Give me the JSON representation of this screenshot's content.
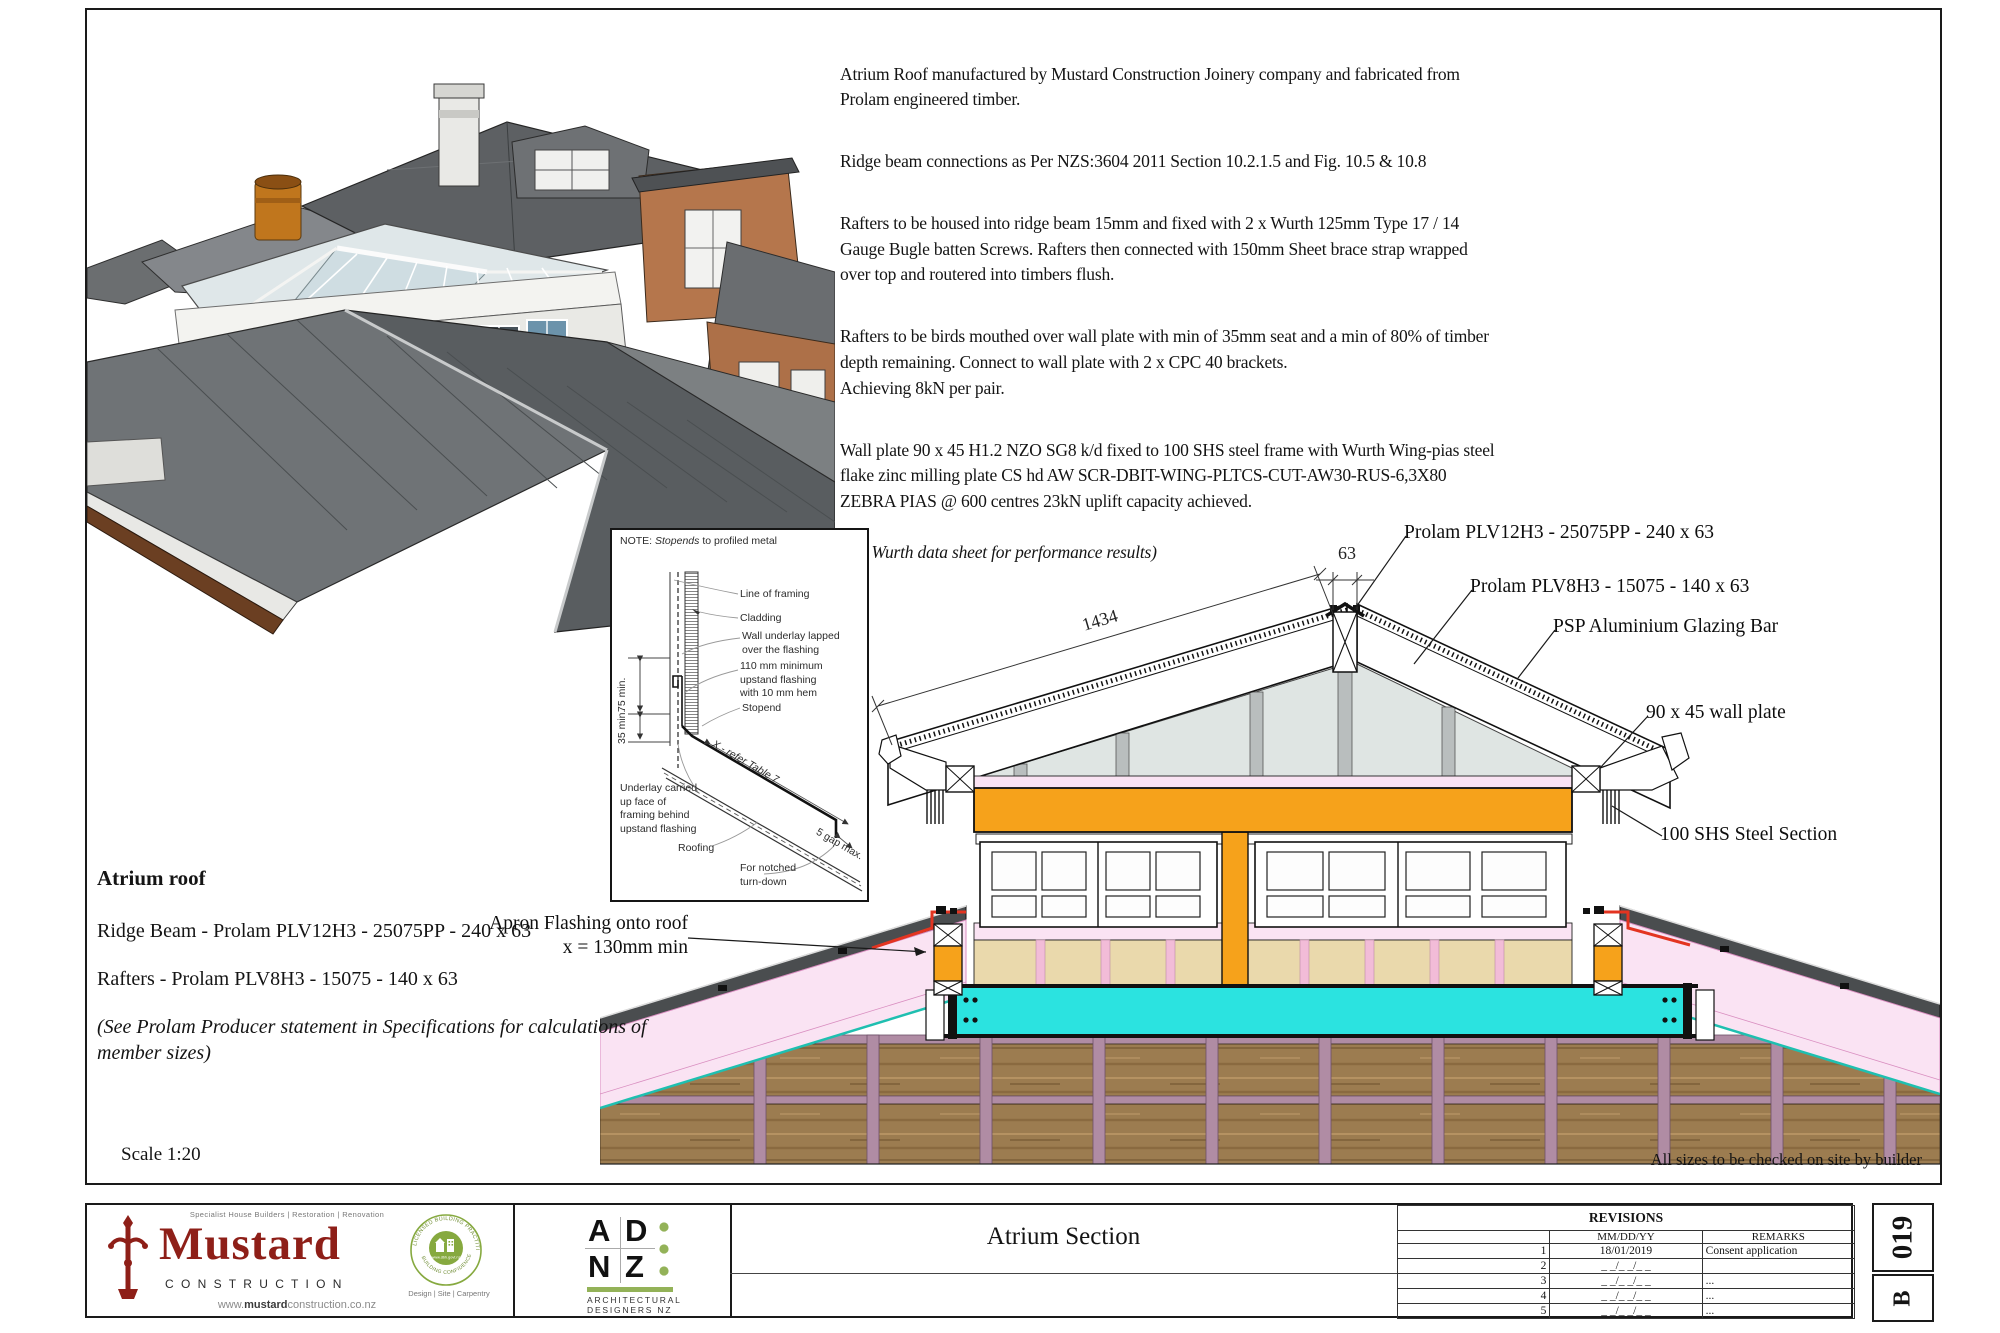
{
  "colors": {
    "orange": "#F6A21B",
    "cyan": "#2BE3E0",
    "pink_fill": "#FAE3F3",
    "pink_line": "#D98EC0",
    "tan": "#EAD9AC",
    "mauve": "#B08CA4",
    "wood": "#9C7C50",
    "teal_line": "#1FBFB0",
    "glazing": "#DFE5E3",
    "mullion_grey": "#B9BEBE",
    "flashing_red": "#E33420",
    "mustard_red": "#8E1F18",
    "adnz_green": "#93B258",
    "badge_green": "#86A93F"
  },
  "spec_notes": {
    "p1": "Atrium Roof manufactured by Mustard Construction Joinery company and fabricated from\nProlam engineered timber.",
    "p2": "Ridge beam connections  as Per NZS:3604 2011 Section 10.2.1.5 and Fig. 10.5 & 10.8",
    "p3": "Rafters to be housed into ridge beam 15mm and fixed with 2 x Wurth 125mm Type 17 / 14\nGauge Bugle batten Screws. Rafters then connected with 150mm Sheet brace strap wrapped\nover top and routered  into timbers flush.",
    "p4": "Rafters to be birds mouthed over wall plate with min of 35mm seat and a min of 80% of timber\ndepth remaining. Connect to wall plate with 2 x CPC 40 brackets.\nAchieving 8kN per pair.",
    "p5": "Wall plate 90 x 45 H1.2 NZO SG8 k/d fixed to 100 SHS steel frame with Wurth Wing-pias steel\nflake zinc milling plate CS hd AW SCR-DBIT-WING-PLTCS-CUT-AW30-RUS-6,3X80\nZEBRA PIAS @ 600 centres 23kN uplift capacity achieved.",
    "p6": "(see Wurth data sheet for performance results)"
  },
  "inset": {
    "note_prefix": "NOTE:",
    "note_italic": "Stopends",
    "note_suffix": "to profiled metal",
    "labels": {
      "line_of_framing": "Line of framing",
      "cladding": "Cladding",
      "wall_underlay": "Wall underlay lapped\nover the flashing",
      "upstand": "110 mm minimum\nupstand flashing\nwith 10 mm hem",
      "stopend": "Stopend",
      "x_refer": "X - refer Table 7",
      "gap": "5 gap max.",
      "underlay_carried": "Underlay carried\nup face of\nframing behind\nupstand flashing",
      "roofing": "Roofing",
      "notched": "For notched\nturn-down",
      "dim75": "75 min.",
      "dim35": "35 min."
    }
  },
  "section": {
    "labels": {
      "ridge_beam": "Prolam PLV12H3 - 25075PP - 240 x 63",
      "rafter": "Prolam PLV8H3 - 15075  - 140 x 63",
      "glazing_bar": "PSP Aluminium Glazing Bar",
      "wall_plate": "90 x 45 wall plate",
      "shs": "100 SHS Steel Section",
      "apron": "Apron Flashing onto roof\nx = 130mm min"
    },
    "dims": {
      "ridge_width": "63",
      "rafter_length": "1434"
    }
  },
  "roof_schedule": {
    "heading": "Atrium roof",
    "ridge_beam": "Ridge Beam - Prolam PLV12H3 - 25075PP - 240 x 63",
    "rafters": "Rafters - Prolam PLV8H3 - 15075 - 140 x 63",
    "note": "(See Prolam Producer statement in Specifications for calculations of\nmember sizes)",
    "scale": "Scale 1:20"
  },
  "footer_note": "All sizes to be checked on site by builder",
  "title_block": {
    "mustard": {
      "tagline": "Specialist House Builders | Restoration | Renovation",
      "name": "Mustard",
      "sub": "C O N S T R U C T I O N",
      "badge_top": "LICENSED BUILDING PRACTITIONER",
      "badge_url": "www.dbh.govt.nz",
      "badge_bottom": "BUILDING CONFIDENCE",
      "services": "Design | Site | Carpentry",
      "web_prefix": "www.",
      "web_bold": "mustard",
      "web_suffix": "construction.co.nz"
    },
    "adnz": {
      "l_a": "A",
      "l_d": "D",
      "l_n": "N",
      "l_z": "Z",
      "line1": "ARCHITECTURAL",
      "line2": "DESIGNERS NZ"
    },
    "drawing_title": "Atrium Section",
    "revisions": {
      "header": "REVISIONS",
      "col_date": "MM/DD/YY",
      "col_remarks": "REMARKS",
      "rows": [
        {
          "num": "1",
          "date": "18/01/2019",
          "remarks": "Consent application"
        },
        {
          "num": "2",
          "date": "_ _/_ _/_ _",
          "remarks": ""
        },
        {
          "num": "3",
          "date": "_ _/_ _/_ _",
          "remarks": "..."
        },
        {
          "num": "4",
          "date": "_ _/_ _/_ _",
          "remarks": "..."
        },
        {
          "num": "5",
          "date": "_ _/_ _/_ _",
          "remarks": "..."
        }
      ]
    },
    "sheet_number": "019",
    "revision": "B"
  }
}
